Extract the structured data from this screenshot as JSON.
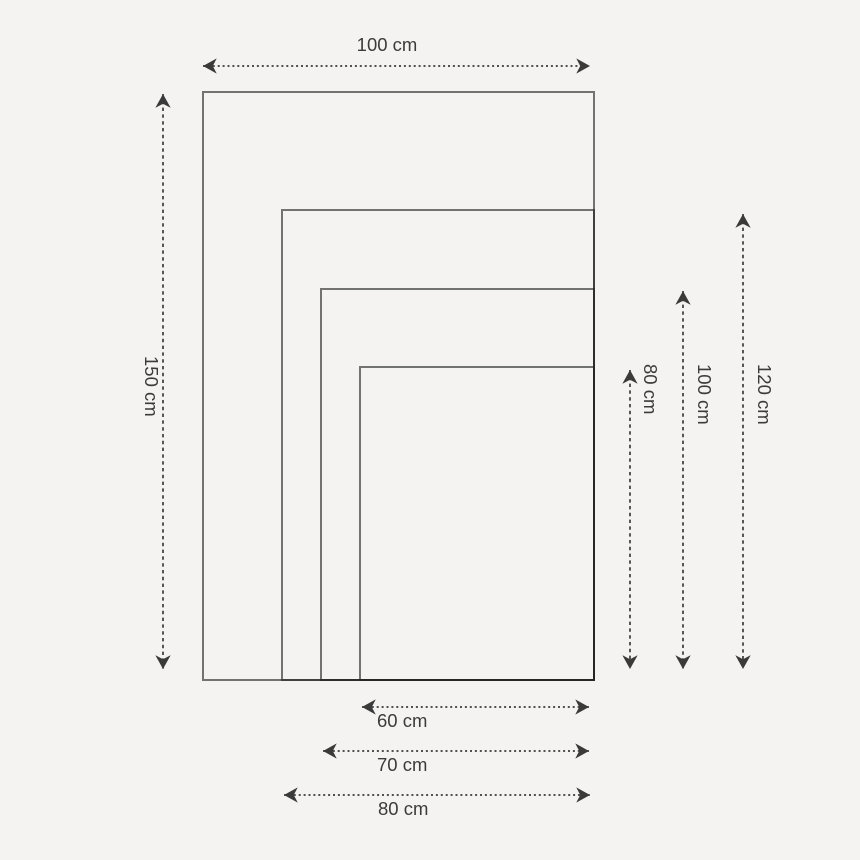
{
  "diagram": {
    "type": "nested-size-comparison",
    "unit": "cm",
    "colors": {
      "background": "#f4f3f1",
      "rectangle_outline": "#222222",
      "arrow": "#3a3a3a",
      "text": "#3b3b3b"
    },
    "sizes": [
      {
        "width_cm": 100,
        "height_cm": 150
      },
      {
        "width_cm": 80,
        "height_cm": 120
      },
      {
        "width_cm": 70,
        "height_cm": 100
      },
      {
        "width_cm": 60,
        "height_cm": 80
      }
    ],
    "labels": {
      "top_width": "100 cm",
      "left_height": "150 cm",
      "right_height_80": "80 cm",
      "right_height_100": "100 cm",
      "right_height_120": "120 cm",
      "bottom_width_60": "60 cm",
      "bottom_width_70": "70 cm",
      "bottom_width_80": "80 cm"
    }
  }
}
